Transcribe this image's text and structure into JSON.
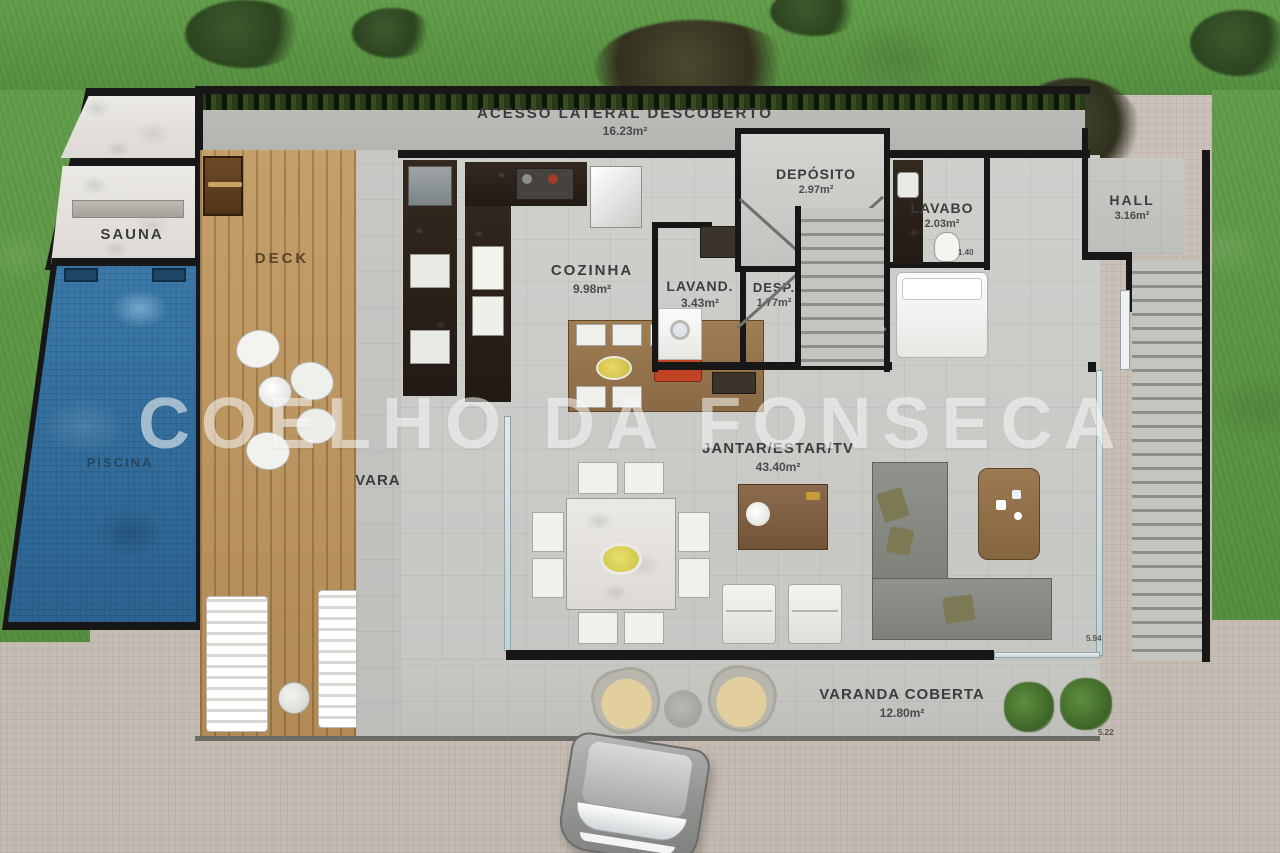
{
  "watermark": "COELHO DA FONSECA",
  "labels": {
    "acesso": {
      "name": "ACESSO LATERAL DESCOBERTO",
      "area": "16.23m²"
    },
    "sauna": {
      "name": "SAUNA"
    },
    "deck": {
      "name": "DECK"
    },
    "piscina": {
      "name": "PISCINA"
    },
    "cozinha": {
      "name": "COZINHA",
      "area": "9.98m²"
    },
    "lavanderia": {
      "name": "LAVAND.",
      "area": "3.43m²"
    },
    "despensa": {
      "name": "DESP.",
      "area": "1.77m²"
    },
    "deposito": {
      "name": "DEPÓSITO",
      "area": "2.97m²"
    },
    "lavabo": {
      "name": "LAVABO",
      "area": "2.03m²"
    },
    "hall": {
      "name": "HALL",
      "area": "3.16m²"
    },
    "varanda_lateral": {
      "name": "VARANDA COBERTA",
      "area": "14.22m²"
    },
    "estar": {
      "name": "JANTAR/ESTAR/TV",
      "area": "43.40m²"
    },
    "varanda_frontal": {
      "name": "VARANDA COBERTA",
      "area": "12.80m²"
    }
  },
  "dimensions": {
    "right_wall": "5.94",
    "front_wall": "5.22",
    "lavabo_side": "1.40"
  },
  "colors": {
    "grass": "#5f9e49",
    "pool_water": "#2f6f9f",
    "deck_wood": "#c09a66",
    "concrete": "#bcbbb7",
    "interior_floor": "#cccccb",
    "wall": "#171717",
    "counter_granite": "#2a211a",
    "island_wood": "#9b7a52",
    "paver": "#c9c2ba",
    "watermark_white": "rgba(255,255,255,0.55)"
  }
}
